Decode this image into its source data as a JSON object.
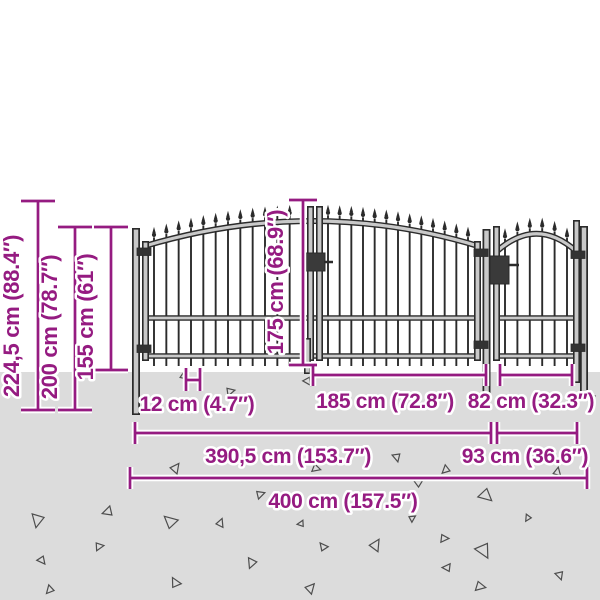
{
  "diagram": {
    "title": "garden-gate-dimension-diagram",
    "colors": {
      "accent": "#951b81",
      "ground": "#dcdcdc",
      "fence_dark": "#2b2b2b",
      "tube_fill": "#c9c9c9",
      "background": "#ffffff",
      "debris": "#4d4d4d"
    },
    "dimensions": {
      "total_height": "224,5 cm (88.4″)",
      "post_height": "200 cm (78.7″)",
      "fence_height": "155 cm (61″)",
      "gate_height": "175 cm (68.9″)",
      "picket_spacing": "12 cm (4.7″)",
      "door_width": "185 cm (72.8″)",
      "wicket_width": "82 cm (32.3″)",
      "main_gate_width": "390,5 cm (153.7″)",
      "side_gate_width": "93 cm (36.6″)",
      "total_width": "400 cm (157.5″)"
    }
  }
}
